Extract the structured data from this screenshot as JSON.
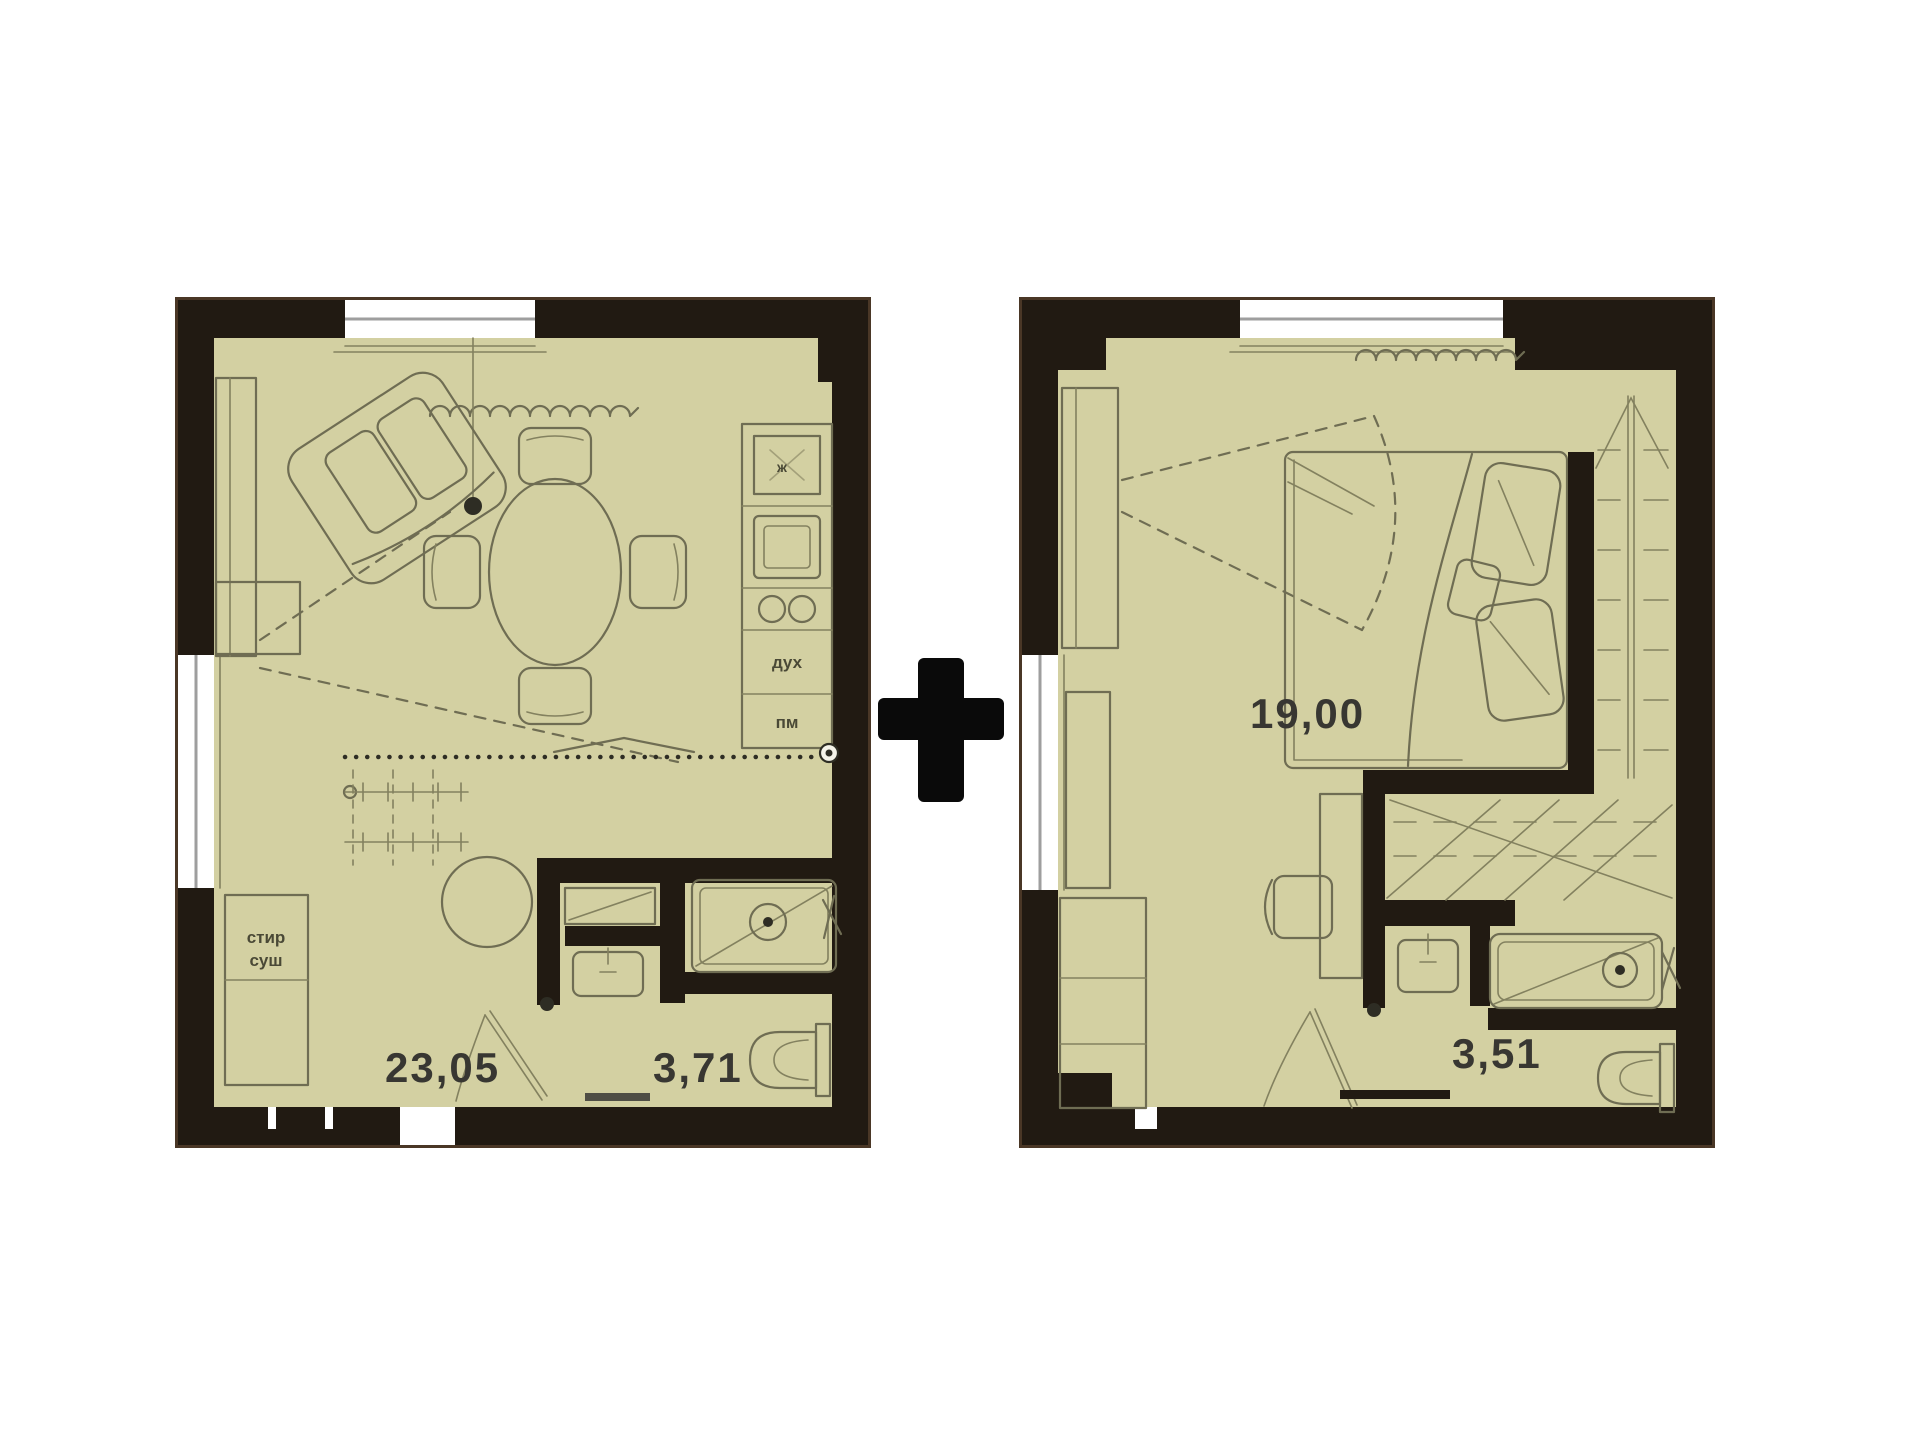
{
  "page": {
    "background": "#ffffff"
  },
  "plus_sign": "+",
  "colors": {
    "floor": "#d3d0a2",
    "walls": "#211a12",
    "furniture_lines": "#6f6d53",
    "window_fill": "#ffffff",
    "window_frame": "#9e9e9e",
    "label_text": "#383732",
    "plus": "#0a0a0a"
  },
  "left_plan": {
    "name": "studio-floor-plan",
    "area_main": "23,05",
    "area_bath": "3,71",
    "labels": {
      "washer": "стир",
      "dryer": "суш",
      "fridge": "ж",
      "oven": "дух",
      "dishwasher": "пм"
    }
  },
  "right_plan": {
    "name": "bedroom-floor-plan",
    "area_bedroom": "19,00",
    "area_bath": "3,51"
  }
}
